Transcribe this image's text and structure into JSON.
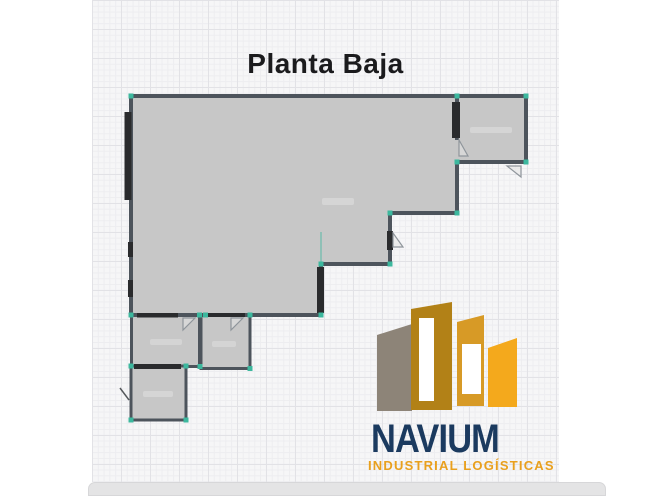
{
  "title": "Planta Baja",
  "logo": {
    "name": "NAVIUM",
    "tagline": "INDUSTRIAL LOGÍSTICAS"
  },
  "theme": {
    "wall_color": "#4d545c",
    "floor_color": "#c7c7c7",
    "handle_color": "#3cb89e",
    "dark_segment_color": "#2a2b2d",
    "logo_navy": "#1b3a5f",
    "logo_gold_dark": "#b28117",
    "logo_gold_mid": "#d79a26",
    "logo_gold_bright": "#f4a91c",
    "logo_gray": "#8d8478",
    "tagline_gold": "#e9a01d"
  }
}
